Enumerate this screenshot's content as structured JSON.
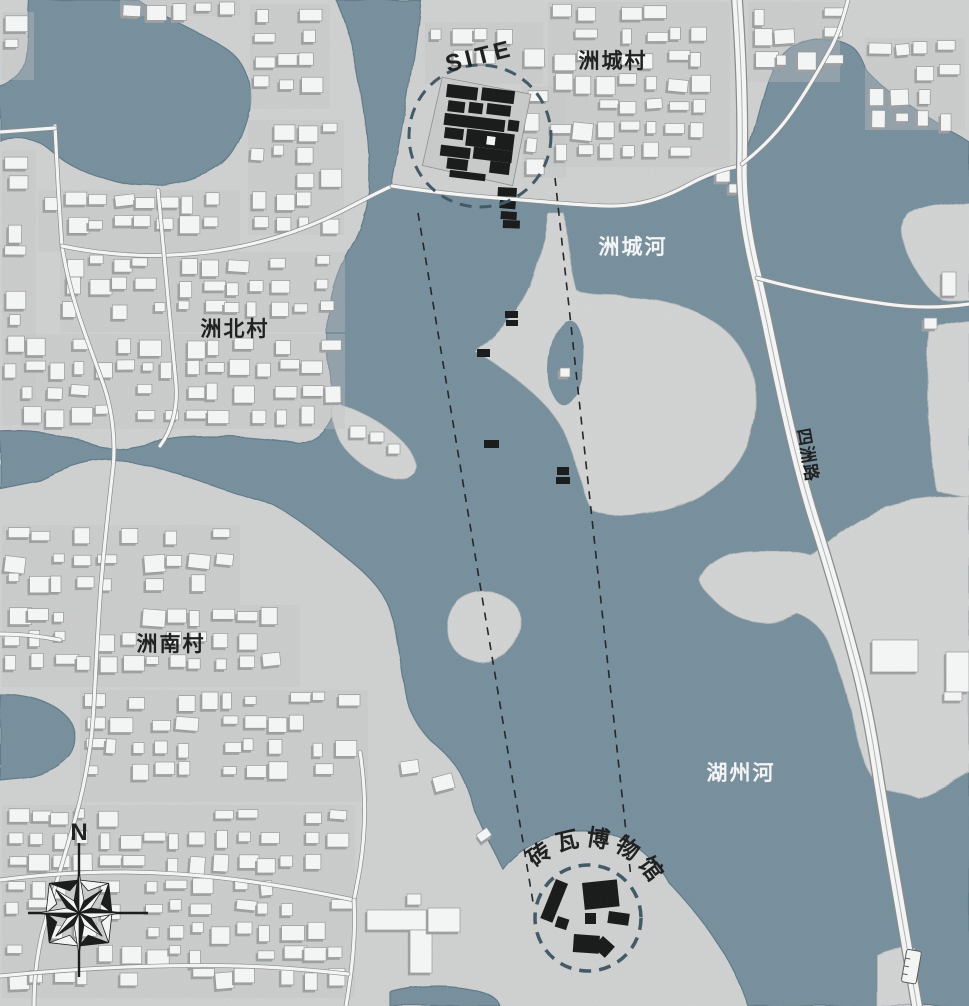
{
  "map": {
    "canvas": {
      "w": 969,
      "h": 1006
    },
    "colors": {
      "base_land": "#d6d6d6",
      "water": "#77909e",
      "water_edge": "#5f7a88",
      "island_land": "#d9d9d9",
      "block_tint": "#c8c8c8",
      "building_fill": "#ffffff",
      "building_stroke": "#999999",
      "building_shadow": "#a3a3a3",
      "black": "#101010",
      "circle_stroke": "#3a5562",
      "sight_line": "#1c1c1c",
      "road_casing": "#8b8b8b",
      "road_fill": "#ffffff",
      "road_center": "#b5b5b5",
      "site_plot": "#cfcfcf"
    },
    "labels": {
      "site": {
        "text": "SITE"
      },
      "zhoucheng_village": {
        "text": "洲城村"
      },
      "zhoucheng_river": {
        "text": "洲城河"
      },
      "zhoubei_village": {
        "text": "洲北村"
      },
      "zhounan_village": {
        "text": "洲南村"
      },
      "huzhou_river": {
        "text": "湖州河"
      },
      "sizhou_road": {
        "text": "四洲路"
      },
      "museum": {
        "text": "砖瓦博物馆"
      }
    },
    "compass": {
      "north_label": "N",
      "cx": 79,
      "cy": 913,
      "r_card": 42,
      "r_diag": 33,
      "r_base": 13,
      "line_top": 843,
      "line_bottom": 977,
      "line_left": 28,
      "line_right": 148
    },
    "site_circle": {
      "cx": 480,
      "cy": 136,
      "r": 71,
      "dash": "12 8",
      "width": 3
    },
    "museum_circle": {
      "cx": 588,
      "cy": 918,
      "r": 53,
      "dash": "12 8",
      "width": 3.5
    },
    "sight_lines": [
      {
        "x1": 418,
        "y1": 213,
        "x2": 534,
        "y2": 908
      },
      {
        "x1": 555,
        "y1": 178,
        "x2": 631,
        "y2": 878
      }
    ],
    "site_complex": {
      "rotate": 7,
      "pivot": [
        478,
        131
      ],
      "plot": "436,82 526,88 519,181 427,172",
      "bars": [
        [
          442,
          88,
          31,
          13
        ],
        [
          477,
          87,
          33,
          13
        ],
        [
          445,
          104,
          17,
          11
        ],
        [
          466,
          103,
          14,
          11
        ],
        [
          484,
          102,
          24,
          11
        ],
        [
          443,
          117,
          61,
          12
        ],
        [
          507,
          116,
          11,
          11
        ],
        [
          445,
          131,
          19,
          11
        ],
        [
          467,
          130,
          48,
          17
        ],
        [
          443,
          149,
          30,
          11
        ],
        [
          476,
          147,
          39,
          12
        ],
        [
          451,
          161,
          21,
          11
        ],
        [
          494,
          159,
          20,
          12
        ],
        [
          455,
          173,
          36,
          7
        ]
      ],
      "hole": [
        487,
        134,
        10,
        10
      ]
    },
    "museum_buildings": [
      [
        556,
        879,
        13,
        42,
        22
      ],
      [
        558,
        916,
        12,
        11,
        18
      ],
      [
        582,
        883,
        35,
        27,
        -6
      ],
      [
        585,
        913,
        11,
        11,
        0
      ],
      [
        609,
        911,
        21,
        12,
        8
      ],
      [
        574,
        934,
        26,
        18,
        4
      ],
      [
        603,
        936,
        16,
        15,
        42
      ]
    ],
    "markers": [
      [
        498,
        187,
        19,
        9,
        3
      ],
      [
        500,
        200,
        16,
        8,
        5
      ],
      [
        501,
        211,
        16,
        8,
        4
      ],
      [
        503,
        220,
        17,
        8,
        2
      ],
      [
        505,
        311,
        13,
        7,
        0
      ],
      [
        506,
        320,
        12,
        6,
        0
      ],
      [
        477,
        349,
        13,
        8,
        0
      ],
      [
        484,
        440,
        15,
        8,
        0
      ],
      [
        557,
        467,
        12,
        8,
        0
      ],
      [
        556,
        477,
        14,
        7,
        0
      ]
    ],
    "geometry": {
      "water": [
        {
          "name": "pond-northwest",
          "d": "M 30 0 L 138 0 C 160 16 200 30 228 50 C 250 66 254 94 246 120 C 238 146 228 164 204 174 C 176 186 146 190 116 182 C 92 176 66 164 50 150 C 36 138 18 136 0 140 L 0 88 C 14 84 24 72 26 56 C 28 36 29 18 30 0 Z"
        },
        {
          "name": "main-river",
          "d": "M 336 0 L 420 0 C 416 40 410 80 404 118 C 399 150 394 170 392 186 C 410 192 430 192 452 194 C 492 198 540 202 584 205 C 618 207 646 203 668 194 C 692 184 716 172 742 166 C 752 142 758 112 766 86 C 772 66 782 50 800 42 C 816 35 834 37 848 44 C 856 48 862 58 866 70 C 882 88 904 102 926 116 C 940 124 956 134 969 142 L 969 1006 L 748 1006 C 740 982 728 958 714 938 C 700 917 684 898 670 884 C 658 864 642 848 620 838 C 600 830 572 828 550 836 C 530 842 514 852 502 868 C 492 850 478 820 468 790 C 462 772 450 756 432 742 C 420 730 410 712 406 694 C 402 672 400 650 396 630 C 390 600 374 580 352 562 C 330 545 302 520 272 504 C 240 496 200 480 160 468 C 140 462 120 458 102 460 C 80 462 60 470 40 480 L 0 488 L 0 432 C 30 430 60 434 96 446 C 120 454 150 440 180 437 C 220 434 262 438 300 444 C 320 440 330 428 336 408 C 330 380 325 350 327 320 C 330 290 340 264 352 244 C 360 230 366 210 368 190 C 370 150 364 110 358 76 C 352 40 344 16 336 0 Z"
        },
        {
          "name": "inlet-west",
          "d": "M 0 694 C 24 694 48 700 64 714 C 76 724 78 742 70 754 C 60 768 40 776 20 778 L 0 780 Z"
        },
        {
          "name": "pond-south",
          "d": "M 390 992 C 420 984 456 984 482 992 C 492 995 498 1000 500 1006 L 390 1006 Z"
        }
      ],
      "land": [
        {
          "name": "island-central",
          "d": "M 548 214 C 544 246 538 276 524 300 C 510 322 494 338 476 352 C 494 362 514 376 534 394 C 552 410 566 430 574 456 C 580 478 584 500 592 510 C 612 518 640 516 668 508 C 696 500 722 484 738 460 C 752 438 758 410 754 384 C 750 358 736 336 714 322 C 690 306 660 298 628 296 C 608 294 588 296 576 290 C 570 266 566 240 564 214 Z"
        },
        {
          "name": "island-small",
          "d": "M 452 610 C 460 594 482 588 500 594 C 516 600 524 616 520 632 C 516 650 500 662 482 662 C 464 662 450 650 448 634 C 447 626 448 618 452 610 Z"
        },
        {
          "name": "peninsula-junction",
          "d": "M 336 404 C 348 408 364 414 380 424 C 396 434 410 446 414 460 C 417 470 412 478 400 478 C 384 478 364 468 350 454 C 338 442 332 424 332 410 Z"
        },
        {
          "name": "tongue-east-1",
          "d": "M 903 228 C 906 216 916 210 930 207 L 969 202 L 969 300 L 942 300 C 928 290 916 272 908 254 C 905 245 902 236 903 228 Z"
        },
        {
          "name": "tongue-east-2",
          "d": "M 930 330 C 940 324 954 321 969 320 L 969 497 L 938 492 C 932 470 928 440 928 408 C 928 380 928 352 930 330 Z"
        },
        {
          "name": "landmass-southeast",
          "d": "M 700 580 C 704 568 714 560 730 554 C 748 548 780 550 812 556 C 830 540 850 522 874 512 C 900 500 934 497 969 496 L 969 772 C 952 782 934 792 918 798 C 904 794 890 792 882 788 C 870 778 864 764 860 750 C 852 720 848 700 843 684 C 837 662 830 644 822 632 C 815 622 806 616 798 614 C 785 620 770 624 758 622 C 740 620 726 612 714 600 C 707 593 701 587 700 580 Z"
        },
        {
          "name": "patch-bottom-right",
          "d": "M 876 954 C 888 948 902 946 914 948 L 917 1006 L 876 1006 Z"
        }
      ],
      "island_pond": {
        "cx": 566,
        "cy": 362,
        "rx": 17,
        "ry": 42,
        "rot": 6
      },
      "roads": [
        {
          "name": "road-left-main",
          "type": "minor",
          "d": "M 55 126 C 57 166 59 206 62 246 C 70 298 86 336 104 386 C 112 410 116 440 113 468 C 108 512 104 548 101 584 C 98 624 96 664 94 704 C 92 742 86 780 76 816 C 66 852 52 896 42 934 C 36 960 34 982 34 1006"
        },
        {
          "name": "road-top-west",
          "type": "minor",
          "d": "M 0 132 L 55 128"
        },
        {
          "name": "road-village-connector",
          "type": "minor",
          "d": "M 62 246 C 110 256 160 258 208 252 C 254 246 300 232 340 212 C 360 202 378 192 392 186"
        },
        {
          "name": "road-shoreline",
          "type": "minor",
          "d": "M 392 186 C 430 192 470 196 510 199 C 548 202 586 206 612 206 C 640 206 664 198 686 186 C 704 176 724 168 742 166"
        },
        {
          "name": "road-sizhou",
          "type": "main",
          "d": "M 737 0 C 741 56 743 112 742 164 C 741 200 748 242 757 278 C 766 316 776 368 786 412 C 795 452 806 496 818 532 C 830 570 845 622 858 672 C 868 712 874 748 879 782 C 884 812 888 838 893 866 C 900 908 908 956 917 1006"
        },
        {
          "name": "road-branch-northeast",
          "type": "minor",
          "d": "M 742 164 C 760 150 778 132 792 112 C 806 92 820 68 832 46 C 838 34 844 16 848 0"
        },
        {
          "name": "road-east-horizontal",
          "type": "minor",
          "d": "M 757 278 C 800 290 844 298 886 304 C 914 308 942 308 969 304"
        },
        {
          "name": "road-village-lane",
          "type": "minor",
          "d": "M 158 190 C 164 256 170 320 176 384 C 178 408 172 430 160 446"
        },
        {
          "name": "road-southwest-1",
          "type": "minor",
          "d": "M 0 880 C 60 872 120 870 178 874 C 238 878 296 888 354 900"
        },
        {
          "name": "road-museum-approach",
          "type": "minor",
          "d": "M 360 752 C 366 790 366 830 360 868 C 358 880 356 890 354 900"
        },
        {
          "name": "road-museum-south",
          "type": "minor",
          "d": "M 354 900 C 356 936 352 970 346 1006"
        },
        {
          "name": "road-southwest-2",
          "type": "minor",
          "d": "M 0 976 C 80 968 160 964 240 966 C 276 967 312 970 348 974"
        },
        {
          "name": "road-west-mid",
          "type": "minor",
          "d": "M 0 634 C 20 634 40 636 60 640"
        }
      ],
      "village_blocks": [
        [
          2,
          12,
          32,
          68
        ],
        [
          250,
          4,
          80,
          105
        ],
        [
          38,
          190,
          202,
          62
        ],
        [
          2,
          150,
          34,
          275
        ],
        [
          60,
          252,
          285,
          80
        ],
        [
          20,
          334,
          325,
          95
        ],
        [
          248,
          120,
          96,
          115
        ],
        [
          120,
          0,
          120,
          16
        ],
        [
          425,
          22,
          118,
          62
        ],
        [
          522,
          86,
          44,
          92
        ],
        [
          548,
          2,
          182,
          165
        ],
        [
          748,
          2,
          92,
          80
        ],
        [
          865,
          38,
          100,
          92
        ],
        [
          2,
          525,
          238,
          80
        ],
        [
          2,
          605,
          298,
          82
        ],
        [
          80,
          690,
          288,
          112
        ],
        [
          2,
          805,
          353,
          193
        ]
      ],
      "white_buildings": [
        [
          367,
          910,
          90,
          20,
          0
        ],
        [
          410,
          930,
          22,
          43,
          0
        ],
        [
          428,
          908,
          32,
          24,
          0
        ],
        [
          400,
          762,
          18,
          13,
          -8
        ],
        [
          432,
          778,
          20,
          15,
          -15
        ],
        [
          476,
          835,
          13,
          9,
          -35
        ],
        [
          407,
          894,
          14,
          11,
          0
        ],
        [
          350,
          426,
          16,
          12,
          0
        ],
        [
          370,
          432,
          14,
          10,
          0
        ],
        [
          388,
          444,
          12,
          10,
          0
        ],
        [
          872,
          640,
          46,
          32,
          0
        ],
        [
          946,
          652,
          23,
          40,
          0
        ],
        [
          944,
          692,
          18,
          9,
          0
        ],
        [
          942,
          272,
          14,
          24,
          0
        ],
        [
          924,
          318,
          13,
          11,
          0
        ],
        [
          716,
          170,
          14,
          12,
          0
        ],
        [
          729,
          184,
          11,
          9,
          0
        ],
        [
          560,
          368,
          10,
          9,
          0
        ]
      ],
      "bridge": {
        "x": 904,
        "y": 950,
        "w": 15,
        "h": 33,
        "rot": 10,
        "cx": 911,
        "cy": 966
      }
    }
  }
}
